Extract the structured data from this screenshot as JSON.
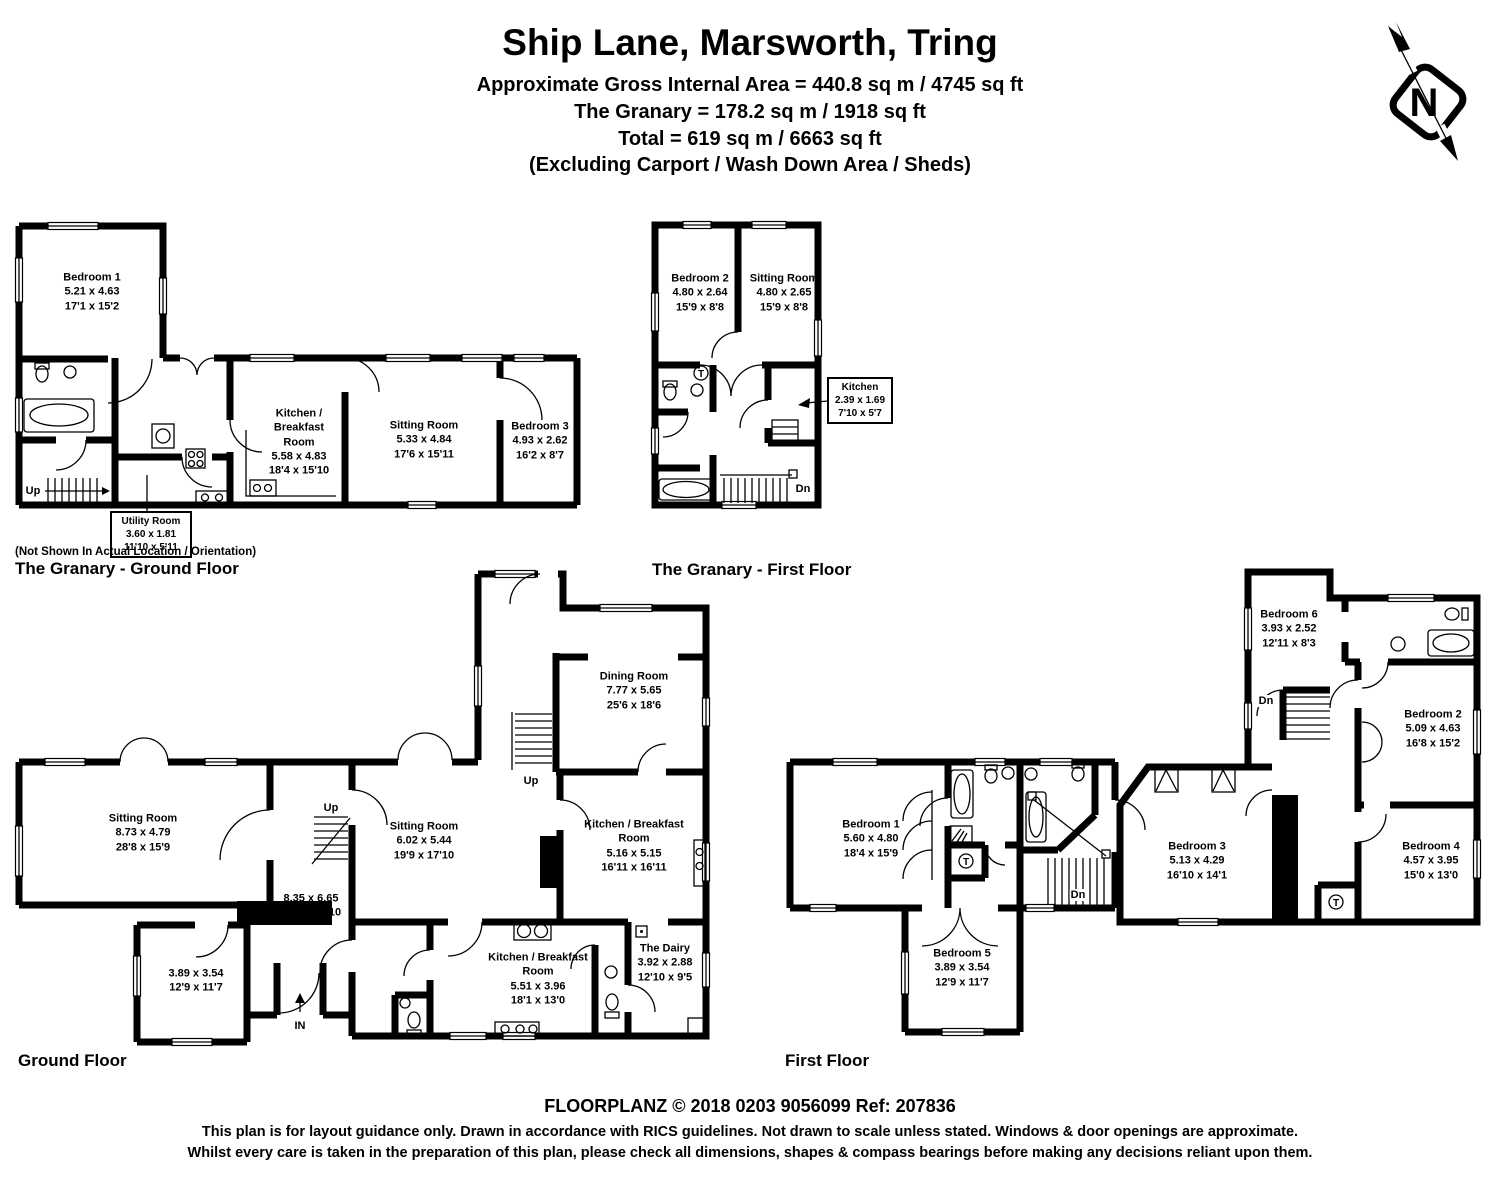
{
  "header": {
    "title": "Ship Lane, Marsworth, Tring",
    "area_line1": "Approximate Gross Internal Area = 440.8 sq m / 4745 sq ft",
    "area_line2": "The Granary = 178.2 sq m / 1918 sq ft",
    "area_line3": "Total = 619 sq m / 6663 sq ft",
    "area_line4": "(Excluding Carport / Wash Down Area / Sheds)"
  },
  "compass": {
    "north_letter": "N"
  },
  "granary_ground_floor": {
    "note": "(Not Shown In Actual Location / Orientation)",
    "caption": "The Granary - Ground Floor",
    "stairs_label": "Up",
    "rooms": {
      "bedroom1": {
        "name": "Bedroom 1",
        "metric": "5.21 x 4.63",
        "imperial": "17'1 x 15'2"
      },
      "kitchen_breakfast": {
        "name": "Kitchen / Breakfast Room",
        "metric": "5.58 x 4.83",
        "imperial": "18'4 x 15'10"
      },
      "sitting_room": {
        "name": "Sitting Room",
        "metric": "5.33 x 4.84",
        "imperial": "17'6 x 15'11"
      },
      "bedroom3": {
        "name": "Bedroom 3",
        "metric": "4.93 x 2.62",
        "imperial": "16'2 x 8'7"
      },
      "utility_room": {
        "name": "Utility Room",
        "metric": "3.60 x 1.81",
        "imperial": "11'10 x 5'11"
      }
    }
  },
  "granary_first_floor": {
    "caption": "The Granary - First Floor",
    "stairs_label": "Dn",
    "tank_label": "T",
    "rooms": {
      "bedroom2": {
        "name": "Bedroom 2",
        "metric": "4.80 x 2.64",
        "imperial": "15'9 x 8'8"
      },
      "sitting_room": {
        "name": "Sitting Room",
        "metric": "4.80 x 2.65",
        "imperial": "15'9 x 8'8"
      },
      "kitchen": {
        "name": "Kitchen",
        "metric": "2.39 x 1.69",
        "imperial": "7'10 x 5'7"
      }
    }
  },
  "ground_floor": {
    "caption": "Ground Floor",
    "up_label": "Up",
    "in_label": "IN",
    "rooms": {
      "sitting_room_west": {
        "name": "Sitting Room",
        "metric": "8.73 x 4.79",
        "imperial": "28'8 x 15'9"
      },
      "family_room": {
        "metric": "3.89 x 3.54",
        "imperial": "12'9 x 11'7"
      },
      "hall": {
        "metric": "8.35 x 6.65",
        "imperial": "27'5 x 21'10"
      },
      "sitting_room_middle": {
        "name": "Sitting Room",
        "metric": "6.02 x 5.44",
        "imperial": "19'9 x 17'10"
      },
      "dining_room": {
        "name": "Dining Room",
        "metric": "7.77 x 5.65",
        "imperial": "25'6 x 18'6"
      },
      "kitchen_breakfast_main": {
        "name": "Kitchen / Breakfast Room",
        "metric": "5.16 x 5.15",
        "imperial": "16'11 x 16'11"
      },
      "kitchen_breakfast_rear": {
        "name": "Kitchen / Breakfast Room",
        "metric": "5.51 x 3.96",
        "imperial": "18'1 x 13'0"
      },
      "dairy": {
        "name": "The Dairy",
        "metric": "3.92 x 2.88",
        "imperial": "12'10 x 9'5"
      }
    }
  },
  "first_floor": {
    "caption": "First Floor",
    "dn_label": "Dn",
    "tank_label": "T",
    "rooms": {
      "bedroom1": {
        "name": "Bedroom 1",
        "metric": "5.60 x 4.80",
        "imperial": "18'4 x 15'9"
      },
      "bedroom2": {
        "name": "Bedroom 2",
        "metric": "5.09 x 4.63",
        "imperial": "16'8 x 15'2"
      },
      "bedroom3": {
        "name": "Bedroom 3",
        "metric": "5.13 x 4.29",
        "imperial": "16'10 x 14'1"
      },
      "bedroom4": {
        "name": "Bedroom 4",
        "metric": "4.57 x 3.95",
        "imperial": "15'0 x 13'0"
      },
      "bedroom5": {
        "name": "Bedroom 5",
        "metric": "3.89 x 3.54",
        "imperial": "12'9 x 11'7"
      },
      "bedroom6": {
        "name": "Bedroom 6",
        "metric": "3.93 x 2.52",
        "imperial": "12'11 x 8'3"
      }
    }
  },
  "footer": {
    "line1": "FLOORPLANZ © 2018   0203 9056099   Ref: 207836",
    "line2": "This plan is for layout guidance only. Drawn in accordance with RICS guidelines. Not drawn to scale unless stated. Windows & door openings are approximate.",
    "line3": "Whilst every care is taken in the preparation of this plan, please check all dimensions, shapes & compass bearings before making any decisions reliant upon them."
  }
}
